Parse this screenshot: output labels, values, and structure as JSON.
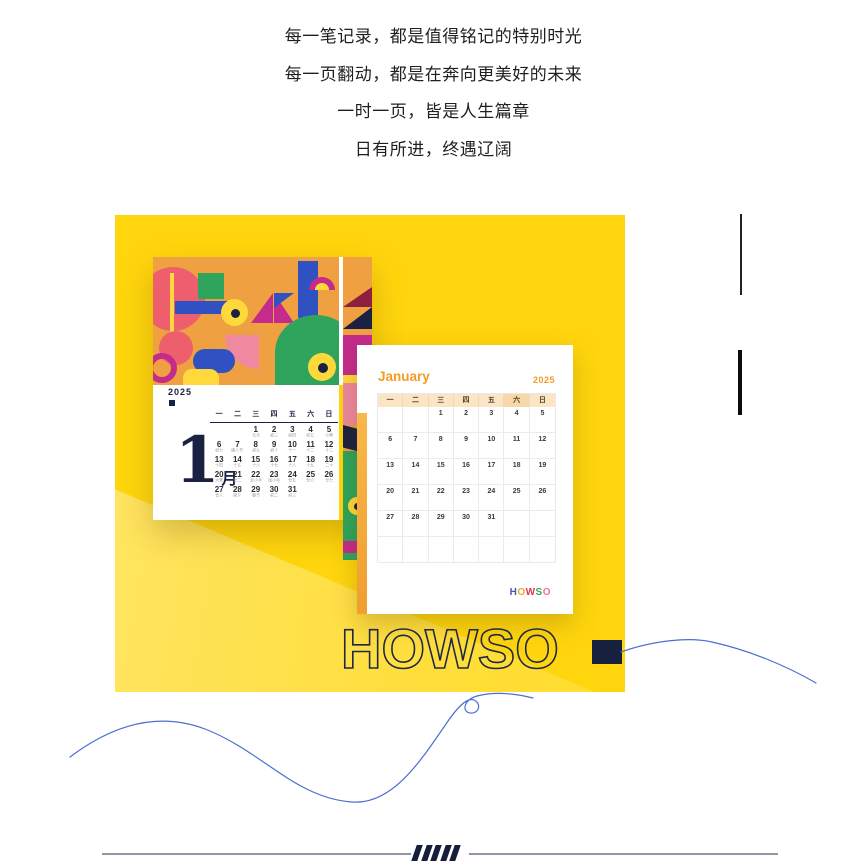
{
  "quote": {
    "lines": [
      "每一笔记录，都是值得铭记的特别时光",
      "每一页翻动，都是在奔向更美好的未来",
      "一时一页，皆是人生篇章",
      "日有所进，终遇辽阔"
    ]
  },
  "desk_calendar": {
    "year": "2025",
    "month_number": "1",
    "month_suffix": "月",
    "weekdays": [
      "一",
      "二",
      "三",
      "四",
      "五",
      "六",
      "日"
    ],
    "cells": [
      {
        "d": "",
        "l": ""
      },
      {
        "d": "",
        "l": ""
      },
      {
        "d": "1",
        "l": "元旦"
      },
      {
        "d": "2",
        "l": "初三"
      },
      {
        "d": "3",
        "l": "初四"
      },
      {
        "d": "4",
        "l": "初五"
      },
      {
        "d": "5",
        "l": "小寒"
      },
      {
        "d": "6",
        "l": "初七"
      },
      {
        "d": "7",
        "l": "腊八节"
      },
      {
        "d": "8",
        "l": "初九"
      },
      {
        "d": "9",
        "l": "初十"
      },
      {
        "d": "10",
        "l": "十一"
      },
      {
        "d": "11",
        "l": "十二"
      },
      {
        "d": "12",
        "l": "十三"
      },
      {
        "d": "13",
        "l": "十四"
      },
      {
        "d": "14",
        "l": "十五"
      },
      {
        "d": "15",
        "l": "十六"
      },
      {
        "d": "16",
        "l": "十七"
      },
      {
        "d": "17",
        "l": "十八"
      },
      {
        "d": "18",
        "l": "十九"
      },
      {
        "d": "19",
        "l": "二十"
      },
      {
        "d": "20",
        "l": "大寒"
      },
      {
        "d": "21",
        "l": "廿二"
      },
      {
        "d": "22",
        "l": "北小年"
      },
      {
        "d": "23",
        "l": "南小年"
      },
      {
        "d": "24",
        "l": "廿五"
      },
      {
        "d": "25",
        "l": "廿六"
      },
      {
        "d": "26",
        "l": "廿七"
      },
      {
        "d": "27",
        "l": "廿八"
      },
      {
        "d": "28",
        "l": "除夕"
      },
      {
        "d": "29",
        "l": "春节"
      },
      {
        "d": "30",
        "l": "初二"
      },
      {
        "d": "31",
        "l": "初三"
      }
    ]
  },
  "page_calendar": {
    "title": "January",
    "year": "2025",
    "weekdays": [
      "一",
      "二",
      "三",
      "四",
      "五",
      "六",
      "日"
    ],
    "cells": [
      "",
      "",
      "1",
      "2",
      "3",
      "4",
      "5",
      "6",
      "7",
      "8",
      "9",
      "10",
      "11",
      "12",
      "13",
      "14",
      "15",
      "16",
      "17",
      "18",
      "19",
      "20",
      "21",
      "22",
      "23",
      "24",
      "25",
      "26",
      "27",
      "28",
      "29",
      "30",
      "31",
      "",
      "",
      "",
      "",
      "",
      "",
      "",
      "",
      ""
    ],
    "logo_letters": [
      {
        "ch": "H",
        "color": "#4056c8"
      },
      {
        "ch": "O",
        "color": "#f0a32f"
      },
      {
        "ch": "W",
        "color": "#e2334d"
      },
      {
        "ch": "S",
        "color": "#35a855"
      },
      {
        "ch": "O",
        "color": "#f2709f"
      }
    ]
  },
  "branding": {
    "outline_text": "HOWSO"
  },
  "colors": {
    "hero_yellow": "#ffd60d",
    "hero_yellow_light": "#ffe565",
    "navy": "#1a2142",
    "orange_accent": "#f59a23",
    "curve_blue": "#4b6fd2"
  }
}
